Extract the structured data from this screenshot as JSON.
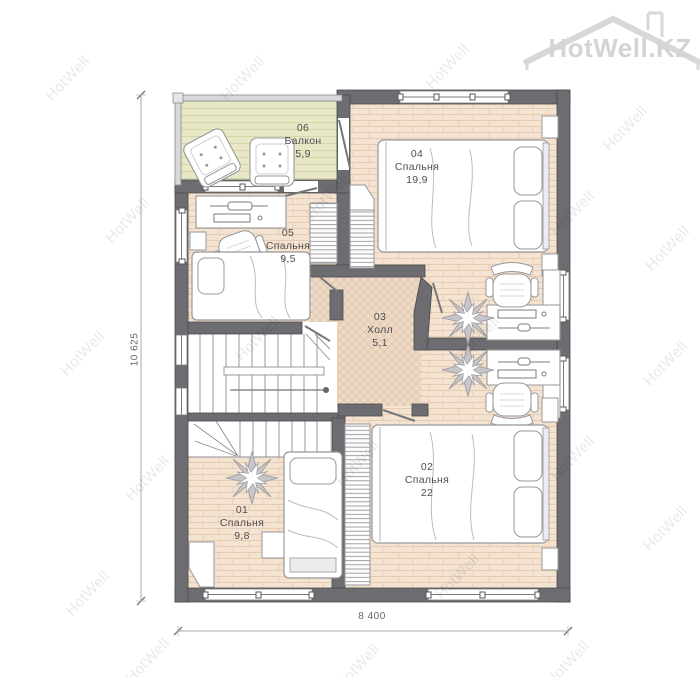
{
  "watermark": {
    "text": "HotWell",
    "logo_text": "HotWell.KZ"
  },
  "dimensions": {
    "width_label": "8 400",
    "height_label": "10 625"
  },
  "rooms": [
    {
      "number": "01",
      "name": "Спальня",
      "area": "9,8"
    },
    {
      "number": "02",
      "name": "Спальня",
      "area": "22"
    },
    {
      "number": "03",
      "name": "Холл",
      "area": "5,1"
    },
    {
      "number": "04",
      "name": "Спальня",
      "area": "19,9"
    },
    {
      "number": "05",
      "name": "Спальня",
      "area": "9,5"
    },
    {
      "number": "06",
      "name": "Балкон",
      "area": "5,9"
    }
  ],
  "colors": {
    "wall": "#6d6d71",
    "bedroom_floor": "#f5e3d1",
    "hall_floor": "#eedac6",
    "balcony_floor": "#e8e8c6",
    "furniture_stroke": "#97979b",
    "watermark_gray": "#aeaeb2",
    "label_text": "#4e4e55"
  }
}
